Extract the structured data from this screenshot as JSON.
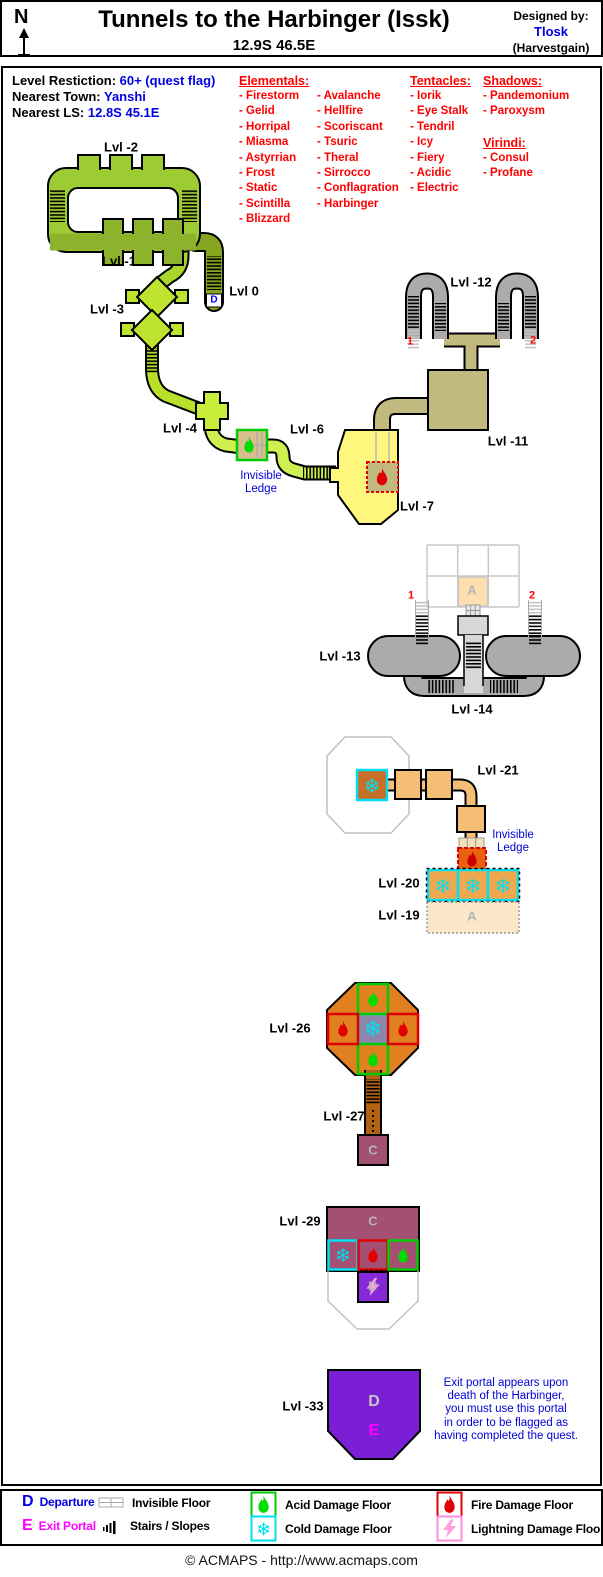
{
  "header": {
    "north": "N",
    "title": "Tunnels to the Harbinger (Issk)",
    "coords": "12.9S 46.5E",
    "designed_by": "Designed by:",
    "designer": "Tlosk",
    "guild": "(Harvestgain)"
  },
  "info": {
    "rows": [
      {
        "label": "Level Restiction:",
        "value": "60+ (quest flag)"
      },
      {
        "label": "Nearest Town:",
        "value": "Yanshi"
      },
      {
        "label": "Nearest LS:",
        "value": "12.8S 45.1E"
      }
    ]
  },
  "bestiary": {
    "groups": [
      {
        "title": "Elementals:",
        "x": 239,
        "y": 74,
        "columns": [
          [
            "- Firestorm",
            "- Gelid",
            "- Horripal",
            "- Miasma",
            "- Astyrrian",
            "- Frost",
            "- Static",
            "- Scintilla",
            "- Blizzard"
          ],
          [
            "- Avalanche",
            "- Hellfire",
            "- Scoriscant",
            "- Tsuric",
            "- Theral",
            "- Sirrocco",
            "- Conflagration",
            "- Harbinger"
          ]
        ]
      },
      {
        "title": "Tentacles:",
        "x": 410,
        "y": 74,
        "columns": [
          [
            "- Iorik",
            "- Eye Stalk",
            "- Tendril",
            "- Icy",
            "- Fiery",
            "- Acidic",
            "- Electric"
          ]
        ]
      },
      {
        "title": "Shadows:",
        "x": 483,
        "y": 74,
        "columns": [
          [
            "- Pandemonium",
            "- Paroxysm"
          ]
        ]
      },
      {
        "title": "Virindi:",
        "x": 483,
        "y": 136,
        "columns": [
          [
            "- Consul",
            "- Profane"
          ]
        ]
      }
    ]
  },
  "map": {
    "labels": [
      {
        "name": "label-lvl-2",
        "text": "Lvl -2",
        "x": 121,
        "y": 148,
        "cls": "lvl"
      },
      {
        "name": "label-lvl-1",
        "text": "Lvl -1",
        "x": 119,
        "y": 262,
        "cls": "lvl"
      },
      {
        "name": "label-lvl-3",
        "text": "Lvl -3",
        "x": 107,
        "y": 310,
        "cls": "lvl"
      },
      {
        "name": "label-lvl-0",
        "text": "Lvl 0",
        "x": 244,
        "y": 292,
        "cls": "lvl"
      },
      {
        "name": "departure-marker-lvl-0",
        "text": "D",
        "x": 214,
        "y": 300,
        "cls": "dmark"
      },
      {
        "name": "label-lvl-4",
        "text": "Lvl -4",
        "x": 180,
        "y": 429,
        "cls": "lvl"
      },
      {
        "name": "label-lvl-6",
        "text": "Lvl -6",
        "x": 307,
        "y": 430,
        "cls": "lvl"
      },
      {
        "name": "note-invisible-ledge-1",
        "text": "Invisible\nLedge",
        "x": 261,
        "y": 483,
        "cls": "note"
      },
      {
        "name": "label-lvl-7",
        "text": "Lvl -7",
        "x": 417,
        "y": 507,
        "cls": "lvl"
      },
      {
        "name": "label-lvl-11",
        "text": "Lvl -11",
        "x": 508,
        "y": 442,
        "cls": "lvl"
      },
      {
        "name": "label-lvl-12",
        "text": "Lvl -12",
        "x": 471,
        "y": 283,
        "cls": "lvl"
      },
      {
        "name": "stair-marker-1-upper",
        "text": "1",
        "x": 410,
        "y": 342,
        "cls": "num"
      },
      {
        "name": "stair-marker-2-upper",
        "text": "2",
        "x": 533,
        "y": 341,
        "cls": "num"
      },
      {
        "name": "label-lvl-13",
        "text": "Lvl -13",
        "x": 340,
        "y": 657,
        "cls": "lvl"
      },
      {
        "name": "label-lvl-14",
        "text": "Lvl -14",
        "x": 472,
        "y": 710,
        "cls": "lvl"
      },
      {
        "name": "stair-marker-1-lower",
        "text": "1",
        "x": 411,
        "y": 596,
        "cls": "num"
      },
      {
        "name": "stair-marker-2-lower",
        "text": "2",
        "x": 532,
        "y": 596,
        "cls": "num"
      },
      {
        "name": "marker-a-grid",
        "text": "A",
        "x": 472,
        "y": 591,
        "cls": "ltr"
      },
      {
        "name": "label-lvl-21",
        "text": "Lvl -21",
        "x": 498,
        "y": 771,
        "cls": "lvl"
      },
      {
        "name": "note-invisible-ledge-2",
        "text": "Invisible\nLedge",
        "x": 513,
        "y": 842,
        "cls": "note"
      },
      {
        "name": "label-lvl-20",
        "text": "Lvl -20",
        "x": 399,
        "y": 884,
        "cls": "lvl"
      },
      {
        "name": "label-lvl-19",
        "text": "Lvl -19",
        "x": 399,
        "y": 916,
        "cls": "lvl"
      },
      {
        "name": "marker-a-lvl-19",
        "text": "A",
        "x": 472,
        "y": 917,
        "cls": "ltr"
      },
      {
        "name": "label-lvl-26",
        "text": "Lvl -26",
        "x": 290,
        "y": 1029,
        "cls": "lvl"
      },
      {
        "name": "label-lvl-27",
        "text": "Lvl -27",
        "x": 344,
        "y": 1117,
        "cls": "lvl"
      },
      {
        "name": "marker-c-box",
        "text": "C",
        "x": 373,
        "y": 1151,
        "cls": "ltr"
      },
      {
        "name": "label-lvl-29",
        "text": "Lvl -29",
        "x": 300,
        "y": 1222,
        "cls": "lvl"
      },
      {
        "name": "marker-c-lvl-29",
        "text": "C",
        "x": 373,
        "y": 1222,
        "cls": "ltr"
      },
      {
        "name": "marker-d-lightning",
        "text": "D",
        "x": 373,
        "y": 1287,
        "cls": "ltr"
      },
      {
        "name": "label-lvl-33",
        "text": "Lvl -33",
        "x": 303,
        "y": 1407,
        "cls": "lvl"
      },
      {
        "name": "marker-d-lvl-33",
        "text": "D",
        "x": 374,
        "y": 1402,
        "cls": "ltr-big"
      },
      {
        "name": "marker-e-lvl-33",
        "text": "E",
        "x": 374,
        "y": 1431,
        "cls": "e-big"
      },
      {
        "name": "note-exit-portal",
        "text": "Exit portal appears upon\ndeath of the Harbinger,\nyou must use this portal\nin order to be flagged as\nhaving completed the quest.",
        "x": 506,
        "y": 1410,
        "cls": "note",
        "w": 170
      }
    ]
  },
  "legend": {
    "departure": {
      "letter": "D",
      "label": "Departure"
    },
    "exit": {
      "letter": "E",
      "label": "Exit Portal"
    },
    "invisible": "Invisible Floor",
    "stairs": "Stairs / Slopes",
    "acid": "Acid Damage Floor",
    "cold": "Cold Damage Floor",
    "fire": "Fire Damage Floor",
    "lightning": "Lightning Damage Floor"
  },
  "footer": {
    "text": "© ACMAPS - http://www.acmaps.com"
  },
  "colors": {
    "value_blue": "#0000E6",
    "list_red": "#FF0000",
    "exit_magenta": "#FF00FF",
    "acid_green": "#00CC00",
    "fire_red": "#E00000",
    "cold_cyan": "#00E0F0",
    "lightning_pink": "#FF8CDE",
    "portal_purple": "#7B1FD6"
  }
}
